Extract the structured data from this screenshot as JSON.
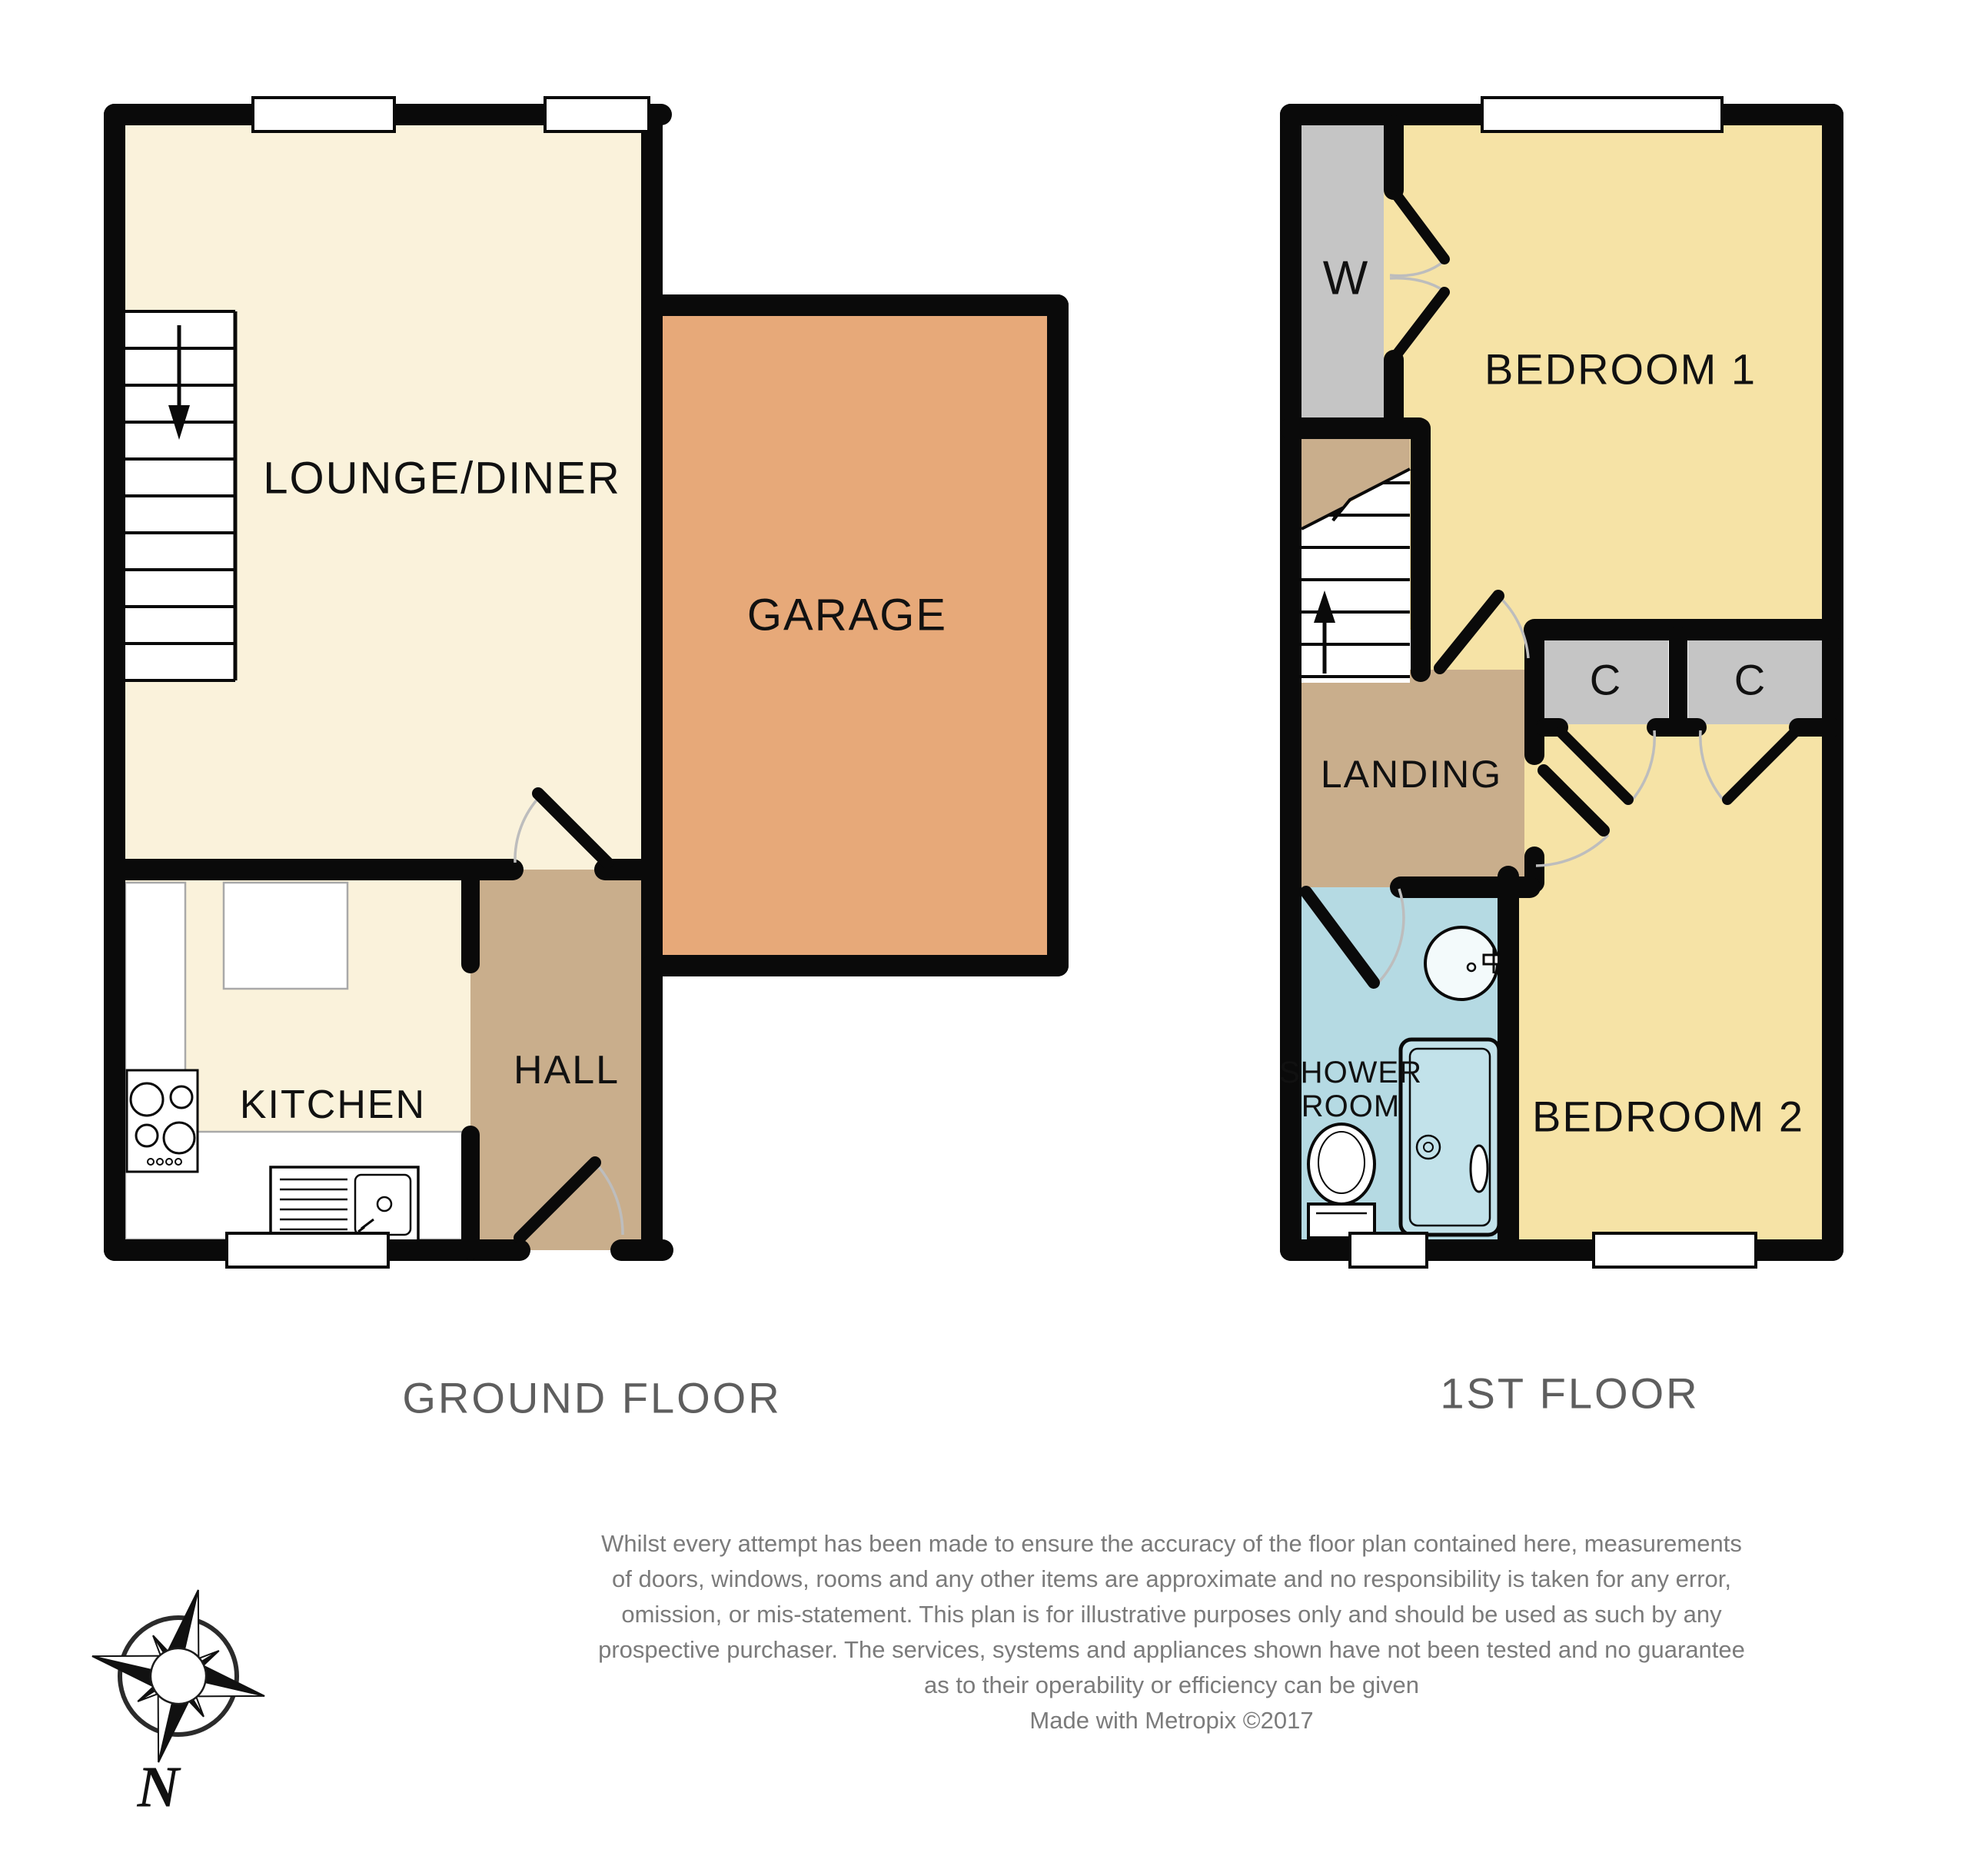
{
  "plan": {
    "ground_floor": {
      "title": "GROUND FLOOR",
      "rooms": {
        "lounge_diner": "LOUNGE/DINER",
        "garage": "GARAGE",
        "kitchen": "KITCHEN",
        "hall": "HALL"
      }
    },
    "first_floor": {
      "title": "1ST FLOOR",
      "rooms": {
        "bedroom1": "BEDROOM 1",
        "bedroom2": "BEDROOM 2",
        "landing": "LANDING",
        "shower_room_line1": "SHOWER",
        "shower_room_line2": "ROOM",
        "wardrobe": "W",
        "cupboard1": "C",
        "cupboard2": "C"
      }
    },
    "compass": {
      "north_label": "N"
    },
    "disclaimer": {
      "lines": [
        "Whilst every attempt has been made to ensure the accuracy of the floor plan contained here, measurements",
        "of doors, windows, rooms and any other items are approximate and no responsibility is taken for any error,",
        "omission, or mis-statement. This plan is for illustrative purposes only and should be used as such by any",
        "prospective purchaser. The services, systems and appliances shown have not been tested and no guarantee",
        "as to their operability or efficiency can be given",
        "Made with Metropix ©2017"
      ]
    },
    "colors": {
      "floor_cream": "#FAF2DB",
      "garage_tan": "#E7A979",
      "hall_tan": "#C9AE8C",
      "bedroom_yellow": "#F6E3A6",
      "closet_gray": "#C5C5C5",
      "shower_blue": "#B5DAE3",
      "wall_black": "#0A0A0A",
      "title_gray": "#5E5E5E",
      "disclaimer_gray": "#7B7B7B"
    }
  }
}
